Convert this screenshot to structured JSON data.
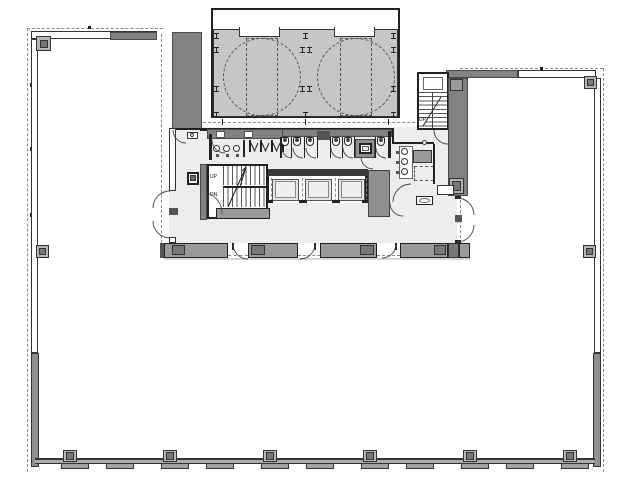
{
  "labels": {
    "stair_main_up": "UP",
    "stair_main_down": "DN",
    "stair_roof_up": "UP"
  },
  "colors": {
    "wall_dark": "#828282",
    "deck_gray": "#c6c6c6",
    "panel_gray": "#9a9a9a",
    "core_bg": "#ededed",
    "band_gray": "#ababab",
    "dash_gray": "#8a8a8a",
    "column_dark": "#777777"
  }
}
